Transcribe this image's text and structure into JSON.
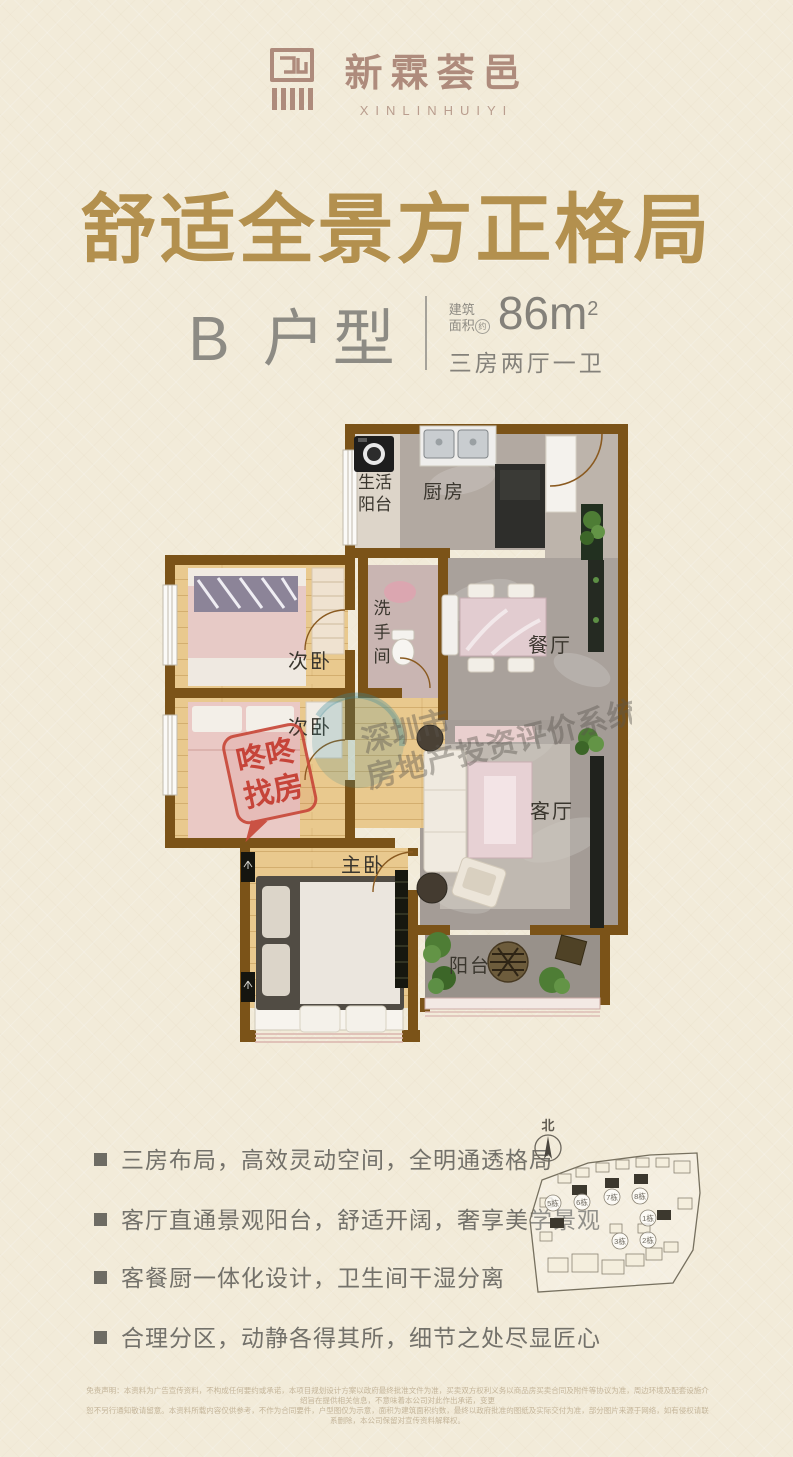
{
  "brand": {
    "name_cn": "新霖荟邑",
    "name_en": "XINLINHUIYI",
    "color": "#ae8b7c"
  },
  "title": {
    "text": "舒适全景方正格局",
    "color": "#b3904e"
  },
  "unit": {
    "name": "B 户型",
    "area_label_1": "建筑",
    "area_label_2": "面积",
    "approx": "约",
    "area_value": "86m",
    "area_sup": "2",
    "config": "三房两厅一卫"
  },
  "floorplan": {
    "wall_color": "#7b5318",
    "rooms": {
      "laundry_l1": "生活",
      "laundry_l2": "阳台",
      "kitchen": "厨房",
      "bath_c1": "洗",
      "bath_c2": "手",
      "bath_c3": "间",
      "bedroom_a": "次卧",
      "bedroom_b": "次卧",
      "dining": "餐厅",
      "living": "客厅",
      "master": "主卧",
      "balcony": "阳台"
    },
    "watermark": {
      "line1": "深圳市",
      "line2": "房地产投资评价系统"
    },
    "stamp": {
      "line1": "咚咚",
      "line2": "找房",
      "color": "#c8483a"
    }
  },
  "features": [
    "三房布局，高效灵动空间，全明通透格局",
    "客厅直通景观阳台，舒适开阔，奢享美学景观",
    "客餐厨一体化设计，卫生间干湿分离",
    "合理分区，动静各得其所，细节之处尽显匠心"
  ],
  "siteplan": {
    "north": "北",
    "buildings": [
      "5栋",
      "6栋",
      "7栋",
      "8栋",
      "1栋",
      "2栋",
      "3栋"
    ]
  },
  "fine_print": {
    "line1": "免责声明：本资料为广告宣传资料，不构成任何要约或承诺，本项目规划设计方案以政府最终批准文件为准，买卖双方权利义务以商品房买卖合同及附件等协议为准，周边环境及配套设施介绍旨在提供相关信息，不意味着本公司对此作出承诺，变更",
    "line2": "恕不另行通知敬请留意。本资料所载内容仅供参考，不作为合同要件，户型图仅为示意，面积为建筑面积约数，最终以政府批准的图纸及实际交付为准，部分图片来源于网络，如有侵权请联系删除，本公司保留对宣传资料解释权。"
  }
}
